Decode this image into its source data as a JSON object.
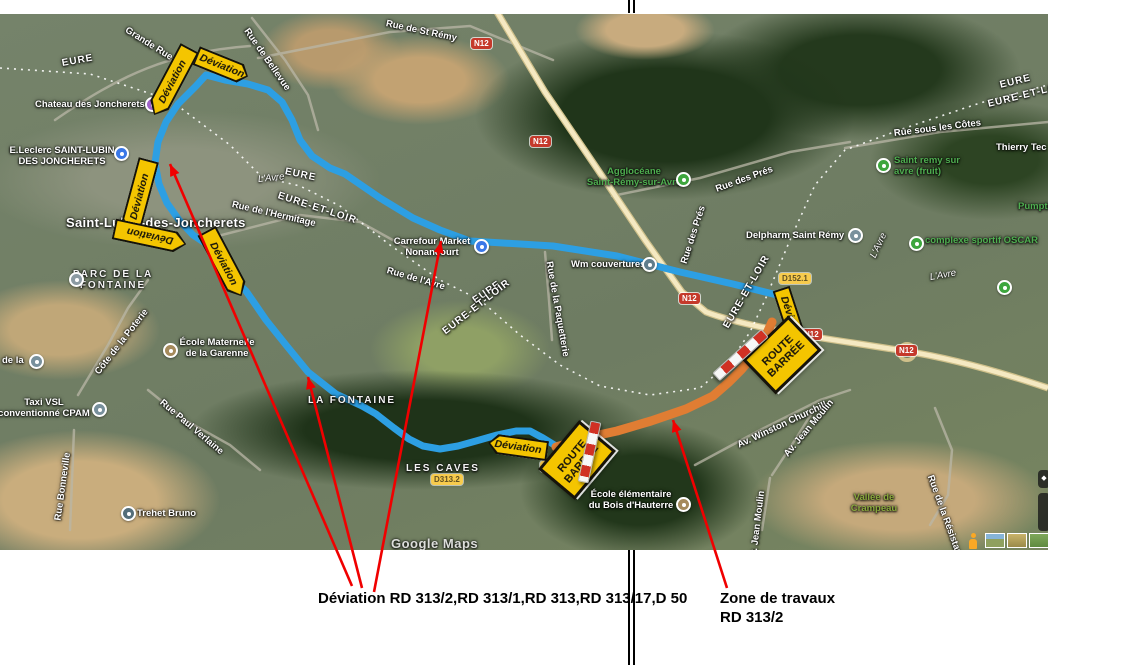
{
  "colors": {
    "detour_route": "#2d9fe3",
    "works_zone": "#e07d33",
    "annotation_red": "#f00000",
    "sign_yellow": "#f4c500"
  },
  "signs": {
    "deviation": "Déviation",
    "route_barree_1": "ROUTE",
    "route_barree_2": "BARRÉE"
  },
  "shields": {
    "n12": "N12",
    "d152_1": "D152.1",
    "d313_2": "D313.2",
    "d313": "D313."
  },
  "annotations": {
    "detour_note": "Déviation RD 313/2,RD 313/1,RD 313,RD 313/17,D 50",
    "works_note_1": "Zone de travaux",
    "works_note_2": "RD 313/2"
  },
  "map": {
    "watermark": "Google Maps",
    "regions": {
      "eure": "EURE",
      "eure_et_loir": "EURE-ET-LOIR"
    },
    "river": "L'Avre",
    "town": "Saint-Lubin-des-Joncherets",
    "areas": {
      "la_fontaine": "LA FONTAINE",
      "les_caves": "LES CAVES",
      "vallee_1": "Vallée de",
      "vallee_2": "Crampeau"
    },
    "streets": {
      "grande_rue": "Grande Rue",
      "bellevue": "Rue de Bellevue",
      "st_remy": "Rue de St Rémy",
      "hermitage": "Rue de l'Hermitage",
      "rue_avre": "Rue de l'Avre",
      "paquetterie": "Rue de la Paquetterie",
      "poterie": "Côte de la Poterie",
      "verlaine": "Rue Paul Verlaine",
      "bonneville": "Rue Bonneville",
      "pres": "Rue des Prés",
      "cotes": "Rue sous les Côtes",
      "churchill": "Av. Winston Churchill",
      "jean_moulin": "Av. Jean Moulin",
      "resistance": "Rue de la Résistance"
    },
    "pois": {
      "chateau": "Chateau des Joncherets",
      "leclerc_1": "E.Leclerc SAINT-LUBIN",
      "leclerc_2": "DES JONCHERETS",
      "carrefour_1": "Carrefour Market",
      "carrefour_2": "Nonancourt",
      "parc_1": "PARC DE LA",
      "parc_2": "FONTAINE",
      "maternelle_1": "École Maternelle",
      "maternelle_2": "de la Garenne",
      "taxi_1": "Taxi VSL",
      "taxi_2": "conventionné CPAM",
      "de_la": "de la",
      "trehet": "Trehet Bruno",
      "elementaire_1": "École élémentaire",
      "elementaire_2": "du Bois d'Hauterre",
      "wm": "Wm couvertures",
      "delpharm": "Delpharm Saint Rémy",
      "agglo_1": "Agglocéane",
      "agglo_2": "Saint-Rémy-sur-Avre",
      "fruit_1": "Saint remy sur",
      "fruit_2": "avre (fruit)",
      "thierry": "Thierry Tec",
      "oscar": "complexe sportif OSCAR",
      "pumptrack": "Pumptr"
    }
  }
}
